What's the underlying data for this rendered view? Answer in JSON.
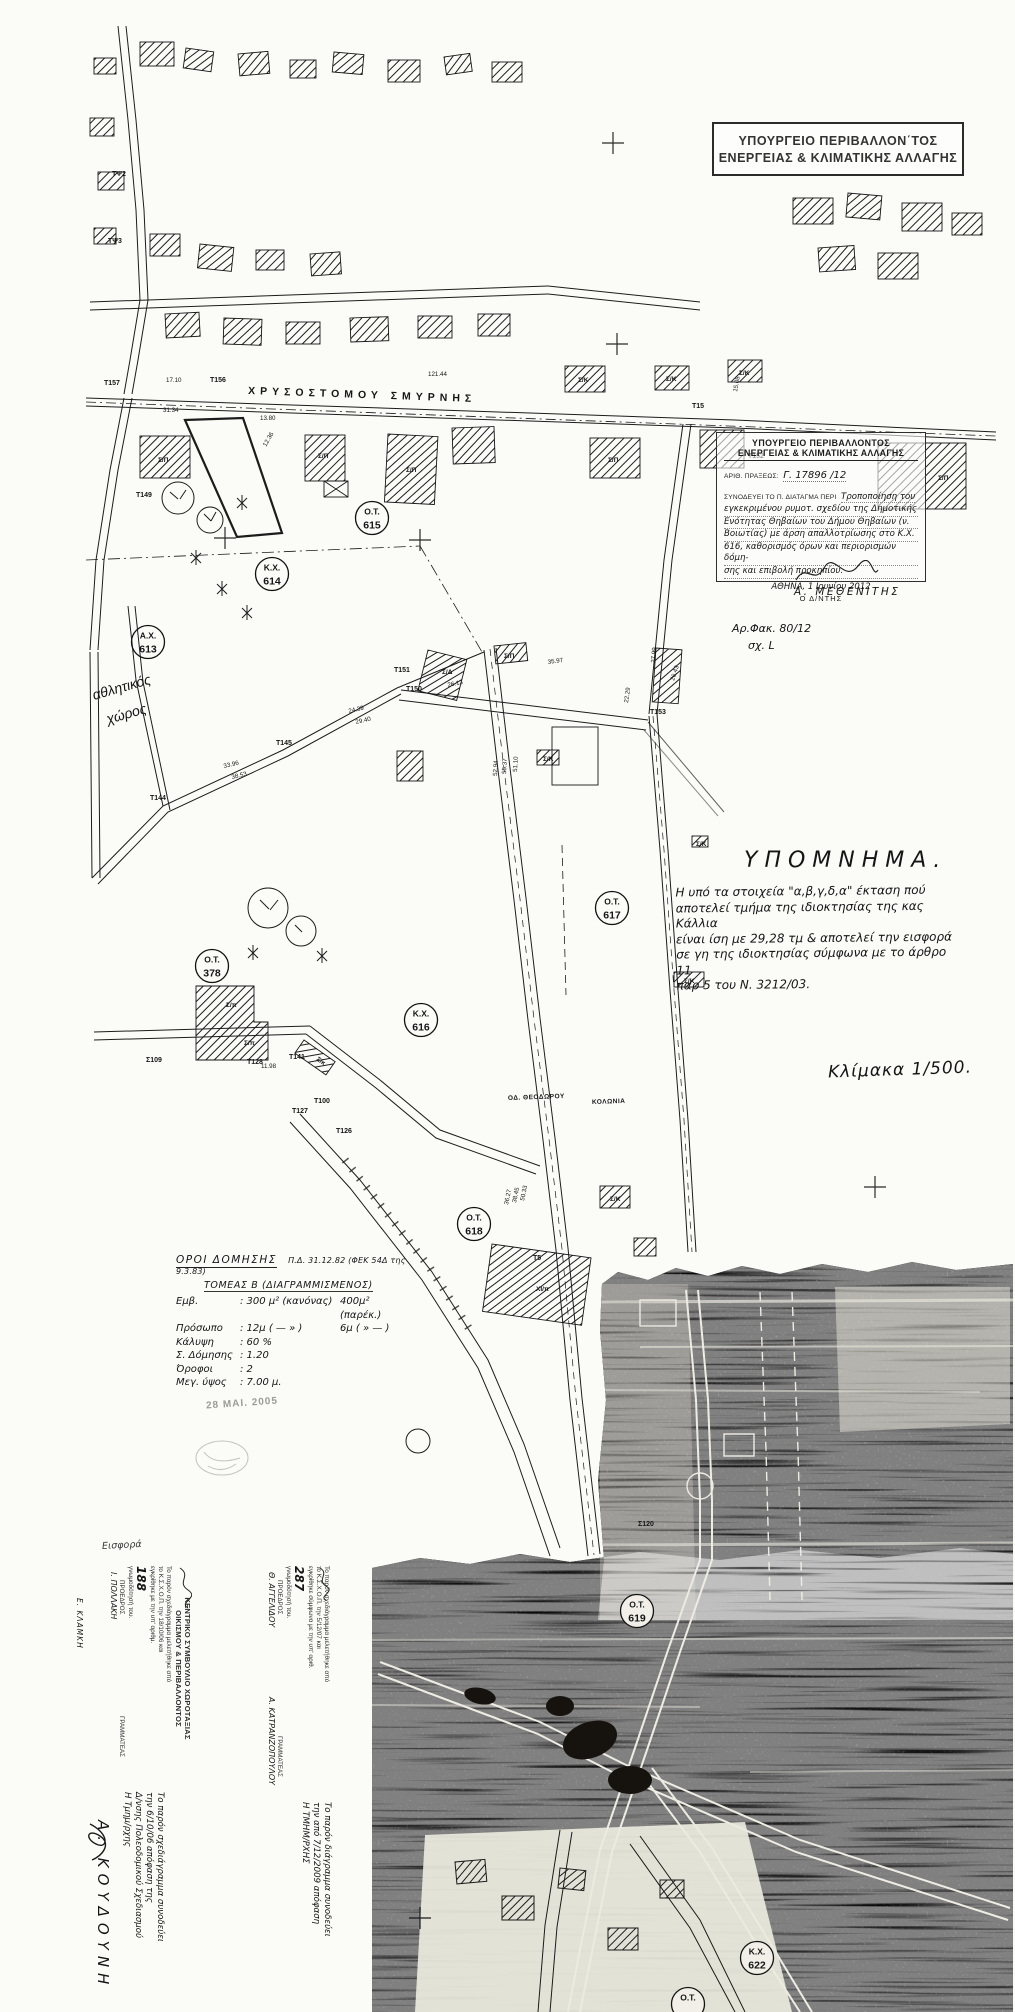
{
  "sheet": {
    "ministry_box": {
      "line1": "ΥΠΟΥΡΓΕΙΟ ΠΕΡΙΒΑΛΛΟΝ΄ΤΟΣ",
      "line2": "ΕΝΕΡΓΕΙΑΣ & ΚΛΙΜΑΤΙΚΗΣ ΑΛΛΑΓΗΣ"
    },
    "approval_stamp": {
      "line1": "ΥΠΟΥΡΓΕΙΟ ΠΕΡΙΒΑΛΛΟΝΤΟΣ",
      "line2": "ΕΝΕΡΓΕΙΑΣ & ΚΛΙΜΑΤΙΚΗΣ ΑΛΛΑΓΗΣ",
      "act_label": "ΑΡΙΘ. ΠΡΑΞΕΩΣ:",
      "act_value": "Γ. 17896 /12",
      "decree_label": "ΣΥΝΟΔΕΥΕΙ ΤΟ Π. ΔΙΑΤΑΓΜΑ ΠΕΡΙ",
      "subject_lines": [
        "Τροποποίηση του",
        "εγκεκριμένου ρυμοτ. σχεδίου της Δημοτικής",
        "Ενότητας Θηβαίων του Δήμου Θηβαίων (ν.",
        "Βοιωτίας) με άρση απαλλοτρίωσης στο Κ.Χ.",
        "616, καθορισμός όρων και περιορισμών δόμη-",
        "σης και επιβολή προκηπίου."
      ],
      "place_date": "ΑΘΗΝΑ, 1 Ιουνίου 2012",
      "signer_title": "Ο Δ/ΝΤΗΣ",
      "signer_name": "Α. ΜΕΘΕΝΙΤΗΣ"
    },
    "file_ref": {
      "line1": "Αρ.Φακ. 80/12",
      "line2": "σχ. L"
    },
    "legend": {
      "title": "ΥΠΟΜΝΗΜΑ.",
      "lines": [
        "Η υπό τα στοιχεία \"α,β,γ,δ,α\" έκταση πού",
        "αποτελεί τμήμα της ιδιοκτησίας της κας Κάλλια",
        "είναι ίση με 29,28 τμ & αποτελεί την εισφορά",
        "σε γη της ιδιοκτησίας σύμφωνα με το άρθρο 11",
        "παρ 5 του Ν. 3212/03."
      ]
    },
    "scale_note": "Κλίμακα 1/500.",
    "building_terms": {
      "title": "ΟΡΟΙ ΔΟΜΗΣΗΣ",
      "title_ref": "Π.Δ. 31.12.82 (ΦΕΚ 54Δ της 9.3.83)",
      "sector": "ΤΟΜΕΑΣ Β (ΔΙΑΓΡΑΜΜΙΣΜΕΝΟΣ)",
      "rows": [
        [
          "Εμβ.",
          ": 300 μ² (κανόνας)",
          "400μ² (παρέκ.)"
        ],
        [
          "Πρόσωπο",
          ": 12μ ( — » )",
          "6μ ( » — )"
        ],
        [
          "Κάλυψη",
          ": 60 %",
          ""
        ],
        [
          "Σ. Δόμησης",
          ": 1.20",
          ""
        ],
        [
          "Όροφοι",
          ": 2",
          ""
        ],
        [
          "Μεγ. ύψος",
          ": 7.00 μ.",
          ""
        ]
      ],
      "date_stamp": "28 ΜΑΙ. 2005"
    },
    "council_stamp_1": {
      "header1": "ΚΕΝΤΡΙΚΟ ΣΥΜΒΟΥΛΙΟ ΧΩΡΟΤΑΞΙΑΣ",
      "header2": "ΟΙΚΙΣΜΟΥ & ΠΕΡΙΒΑΛΛΟΝΤΟΣ",
      "body_lines": [
        "Το παρόν σχεδιάγραμμα μελετήθηκε από",
        "το Κ.Σ.Χ.Ο.Π. την 18/10/06 και",
        "εγκρίθηκε με την υπ' αριθμ.",
        "188",
        "γνωμοδότησή του."
      ],
      "role_left": "ΠΡΟΕΔΡΟΣ",
      "role_right": "ΓΡΑΜΜΑΤΕΑΣ",
      "name_right": "Ι. ΠΟΛΛΑΚΗ"
    },
    "council_stamp_2": {
      "body_lines": [
        "Το παρόν σχεδιάγραμμα μελετήθηκε από",
        "το Κ.Σ.Χ.Ο.Π. την 5/12/07 και",
        "εγκρίθηκε σύμφωνα με την υπ' αριθ.",
        "287",
        "γνωμοδότησή του."
      ],
      "role_left": "ΠΡΟΕΔΡΟΣ",
      "name_left": "Θ. ΑΓΓΕΛΙΔΟΥ",
      "role_right": "ΓΡΑΜΜΑΤΕΑΣ",
      "name_right": "Α. ΚΑΤΡΑΝΖΟΠΟΥΛΟΥ"
    },
    "left_vertical_name": "Ε. ΚΛΑΜΚΗ",
    "bottom_note_left": {
      "lines": [
        "Το παρόν σχεδιάγραμμα συνοδεύει",
        "την 6/10/06 απόφαση της",
        "Δ/νσης Πολεοδομικού Σχεδιασμού",
        "Η Τμημ/ρχης"
      ]
    },
    "bottom_note_center": {
      "lines": [
        "Το παρόν διάγραμμα συνοδεύει",
        "την από 7/12/2009 απόφαση",
        "Η ΤΜΗΜ/ΡΧΗΣ"
      ]
    },
    "bottom_signature_name": "Α. ΚΟΥΔΟΥΝΗ",
    "misc_note": "Εισφορά"
  },
  "map": {
    "street_labels": [
      {
        "text": "ΧΡΥΣΟΣΤΟΜΟΥ ΣΜΥΡΝΗΣ",
        "x": 248,
        "y": 394,
        "rot": 2,
        "size": 10.5,
        "ls": 5
      },
      {
        "text": "ΟΔ. ΘΕΟΔΩΡΟΥ",
        "x": 508,
        "y": 1100,
        "rot": -2,
        "size": 6.5,
        "ls": 0.5
      },
      {
        "text": "ΚΟΛΩΝΙΑ",
        "x": 592,
        "y": 1104,
        "rot": -2,
        "size": 6.5,
        "ls": 0.5
      }
    ],
    "area_label": {
      "line1": "αθλητικός",
      "line2": "χώρος",
      "x": 94,
      "y": 700,
      "rot": -16
    },
    "block_circles": [
      {
        "l1": "Ο.Τ.",
        "l2": "615",
        "x": 372,
        "y": 518
      },
      {
        "l1": "Κ.Χ.",
        "l2": "614",
        "x": 272,
        "y": 574
      },
      {
        "l1": "Α.Χ.",
        "l2": "613",
        "x": 148,
        "y": 642
      },
      {
        "l1": "Ο.Τ.",
        "l2": "617",
        "x": 612,
        "y": 908
      },
      {
        "l1": "Κ.Χ.",
        "l2": "616",
        "x": 421,
        "y": 1020
      },
      {
        "l1": "Ο.Τ.",
        "l2": "378",
        "x": 212,
        "y": 966
      },
      {
        "l1": "Ο.Τ.",
        "l2": "618",
        "x": 474,
        "y": 1224
      },
      {
        "l1": "Ο.Τ.",
        "l2": "619",
        "x": 637,
        "y": 1611,
        "inv": true
      },
      {
        "l1": "Κ.Χ.",
        "l2": "622",
        "x": 757,
        "y": 1958,
        "inv": true
      },
      {
        "l1": "Ο.Τ.",
        "l2": "",
        "x": 688,
        "y": 2004,
        "inv": true
      }
    ],
    "point_labels": [
      {
        "t": "ΤΨ2",
        "x": 112,
        "y": 176
      },
      {
        "t": "ΤΨ3",
        "x": 108,
        "y": 243
      },
      {
        "t": "Τ157",
        "x": 104,
        "y": 385
      },
      {
        "t": "Τ156",
        "x": 210,
        "y": 382
      },
      {
        "t": "Τ15",
        "x": 692,
        "y": 408
      },
      {
        "t": "Τ152",
        "x": 748,
        "y": 458
      },
      {
        "t": "Τ149",
        "x": 136,
        "y": 497
      },
      {
        "t": "Τ151",
        "x": 394,
        "y": 672
      },
      {
        "t": "Τ150",
        "x": 406,
        "y": 691
      },
      {
        "t": "Τ153",
        "x": 650,
        "y": 714
      },
      {
        "t": "Τ144",
        "x": 150,
        "y": 800
      },
      {
        "t": "Τ145",
        "x": 276,
        "y": 745
      },
      {
        "t": "Σ109",
        "x": 146,
        "y": 1062
      },
      {
        "t": "Τ128",
        "x": 247,
        "y": 1064
      },
      {
        "t": "Τ141",
        "x": 289,
        "y": 1059
      },
      {
        "t": "Τ127",
        "x": 292,
        "y": 1113
      },
      {
        "t": "Τ100",
        "x": 314,
        "y": 1103
      },
      {
        "t": "Τ126",
        "x": 336,
        "y": 1133
      },
      {
        "t": "Τ5",
        "x": 533,
        "y": 1260
      },
      {
        "t": "Σ120",
        "x": 638,
        "y": 1526
      }
    ],
    "bldg_labels": [
      {
        "t": "Σ/Π",
        "x": 158,
        "y": 462
      },
      {
        "t": "Σ/Π",
        "x": 318,
        "y": 458
      },
      {
        "t": "Σ/Π",
        "x": 406,
        "y": 472
      },
      {
        "t": "Σ/Π",
        "x": 608,
        "y": 462
      },
      {
        "t": "Σ/Π",
        "x": 938,
        "y": 480
      },
      {
        "t": "Σ/Κ",
        "x": 578,
        "y": 382
      },
      {
        "t": "Σ/Κ",
        "x": 666,
        "y": 381
      },
      {
        "t": "Σ/Κ",
        "x": 739,
        "y": 375
      },
      {
        "t": "Σ/Δ",
        "x": 442,
        "y": 674
      },
      {
        "t": "Σ/Π",
        "x": 504,
        "y": 658
      },
      {
        "t": "Σ/Κ",
        "x": 543,
        "y": 761
      },
      {
        "t": "Σ/Κ",
        "x": 696,
        "y": 846
      },
      {
        "t": "Σ/Κ",
        "x": 684,
        "y": 983
      },
      {
        "t": "Σ/π",
        "x": 226,
        "y": 1007
      },
      {
        "t": "Σ/π",
        "x": 244,
        "y": 1045
      },
      {
        "t": "Σ/κ",
        "x": 316,
        "y": 1060,
        "r": 35
      },
      {
        "t": "ΧΙ/π",
        "x": 536,
        "y": 1291
      },
      {
        "t": "Σ/Κ",
        "x": 610,
        "y": 1201
      }
    ],
    "dim_labels": [
      {
        "t": "17.10",
        "x": 166,
        "y": 382
      },
      {
        "t": "121.44",
        "x": 428,
        "y": 376
      },
      {
        "t": "31.34",
        "x": 163,
        "y": 412
      },
      {
        "t": "13.80",
        "x": 260,
        "y": 420
      },
      {
        "t": "12.36",
        "x": 266,
        "y": 447,
        "r": -60
      },
      {
        "t": "15.08",
        "x": 737,
        "y": 392,
        "r": -80
      },
      {
        "t": "35.97",
        "x": 548,
        "y": 664,
        "r": -8
      },
      {
        "t": "27.99",
        "x": 655,
        "y": 663,
        "r": -85
      },
      {
        "t": "26.43",
        "x": 674,
        "y": 681,
        "r": -72
      },
      {
        "t": "22.29",
        "x": 628,
        "y": 703,
        "r": -82
      },
      {
        "t": "26.13",
        "x": 448,
        "y": 687,
        "r": -12
      },
      {
        "t": "24.39",
        "x": 349,
        "y": 713,
        "r": -13
      },
      {
        "t": "29.40",
        "x": 356,
        "y": 724,
        "r": -13
      },
      {
        "t": "51.10",
        "x": 517,
        "y": 772,
        "r": -87
      },
      {
        "t": "55.37",
        "x": 506,
        "y": 774,
        "r": -87
      },
      {
        "t": "52.94",
        "x": 497,
        "y": 776,
        "r": -87
      },
      {
        "t": "33.96",
        "x": 224,
        "y": 768,
        "r": -13
      },
      {
        "t": "38.53",
        "x": 232,
        "y": 779,
        "r": -13
      },
      {
        "t": "11.98",
        "x": 261,
        "y": 1068
      },
      {
        "t": "50.33",
        "x": 524,
        "y": 1201,
        "r": -78
      },
      {
        "t": "38.45",
        "x": 516,
        "y": 1203,
        "r": -78
      },
      {
        "t": "36.27",
        "x": 508,
        "y": 1205,
        "r": -78
      }
    ]
  }
}
